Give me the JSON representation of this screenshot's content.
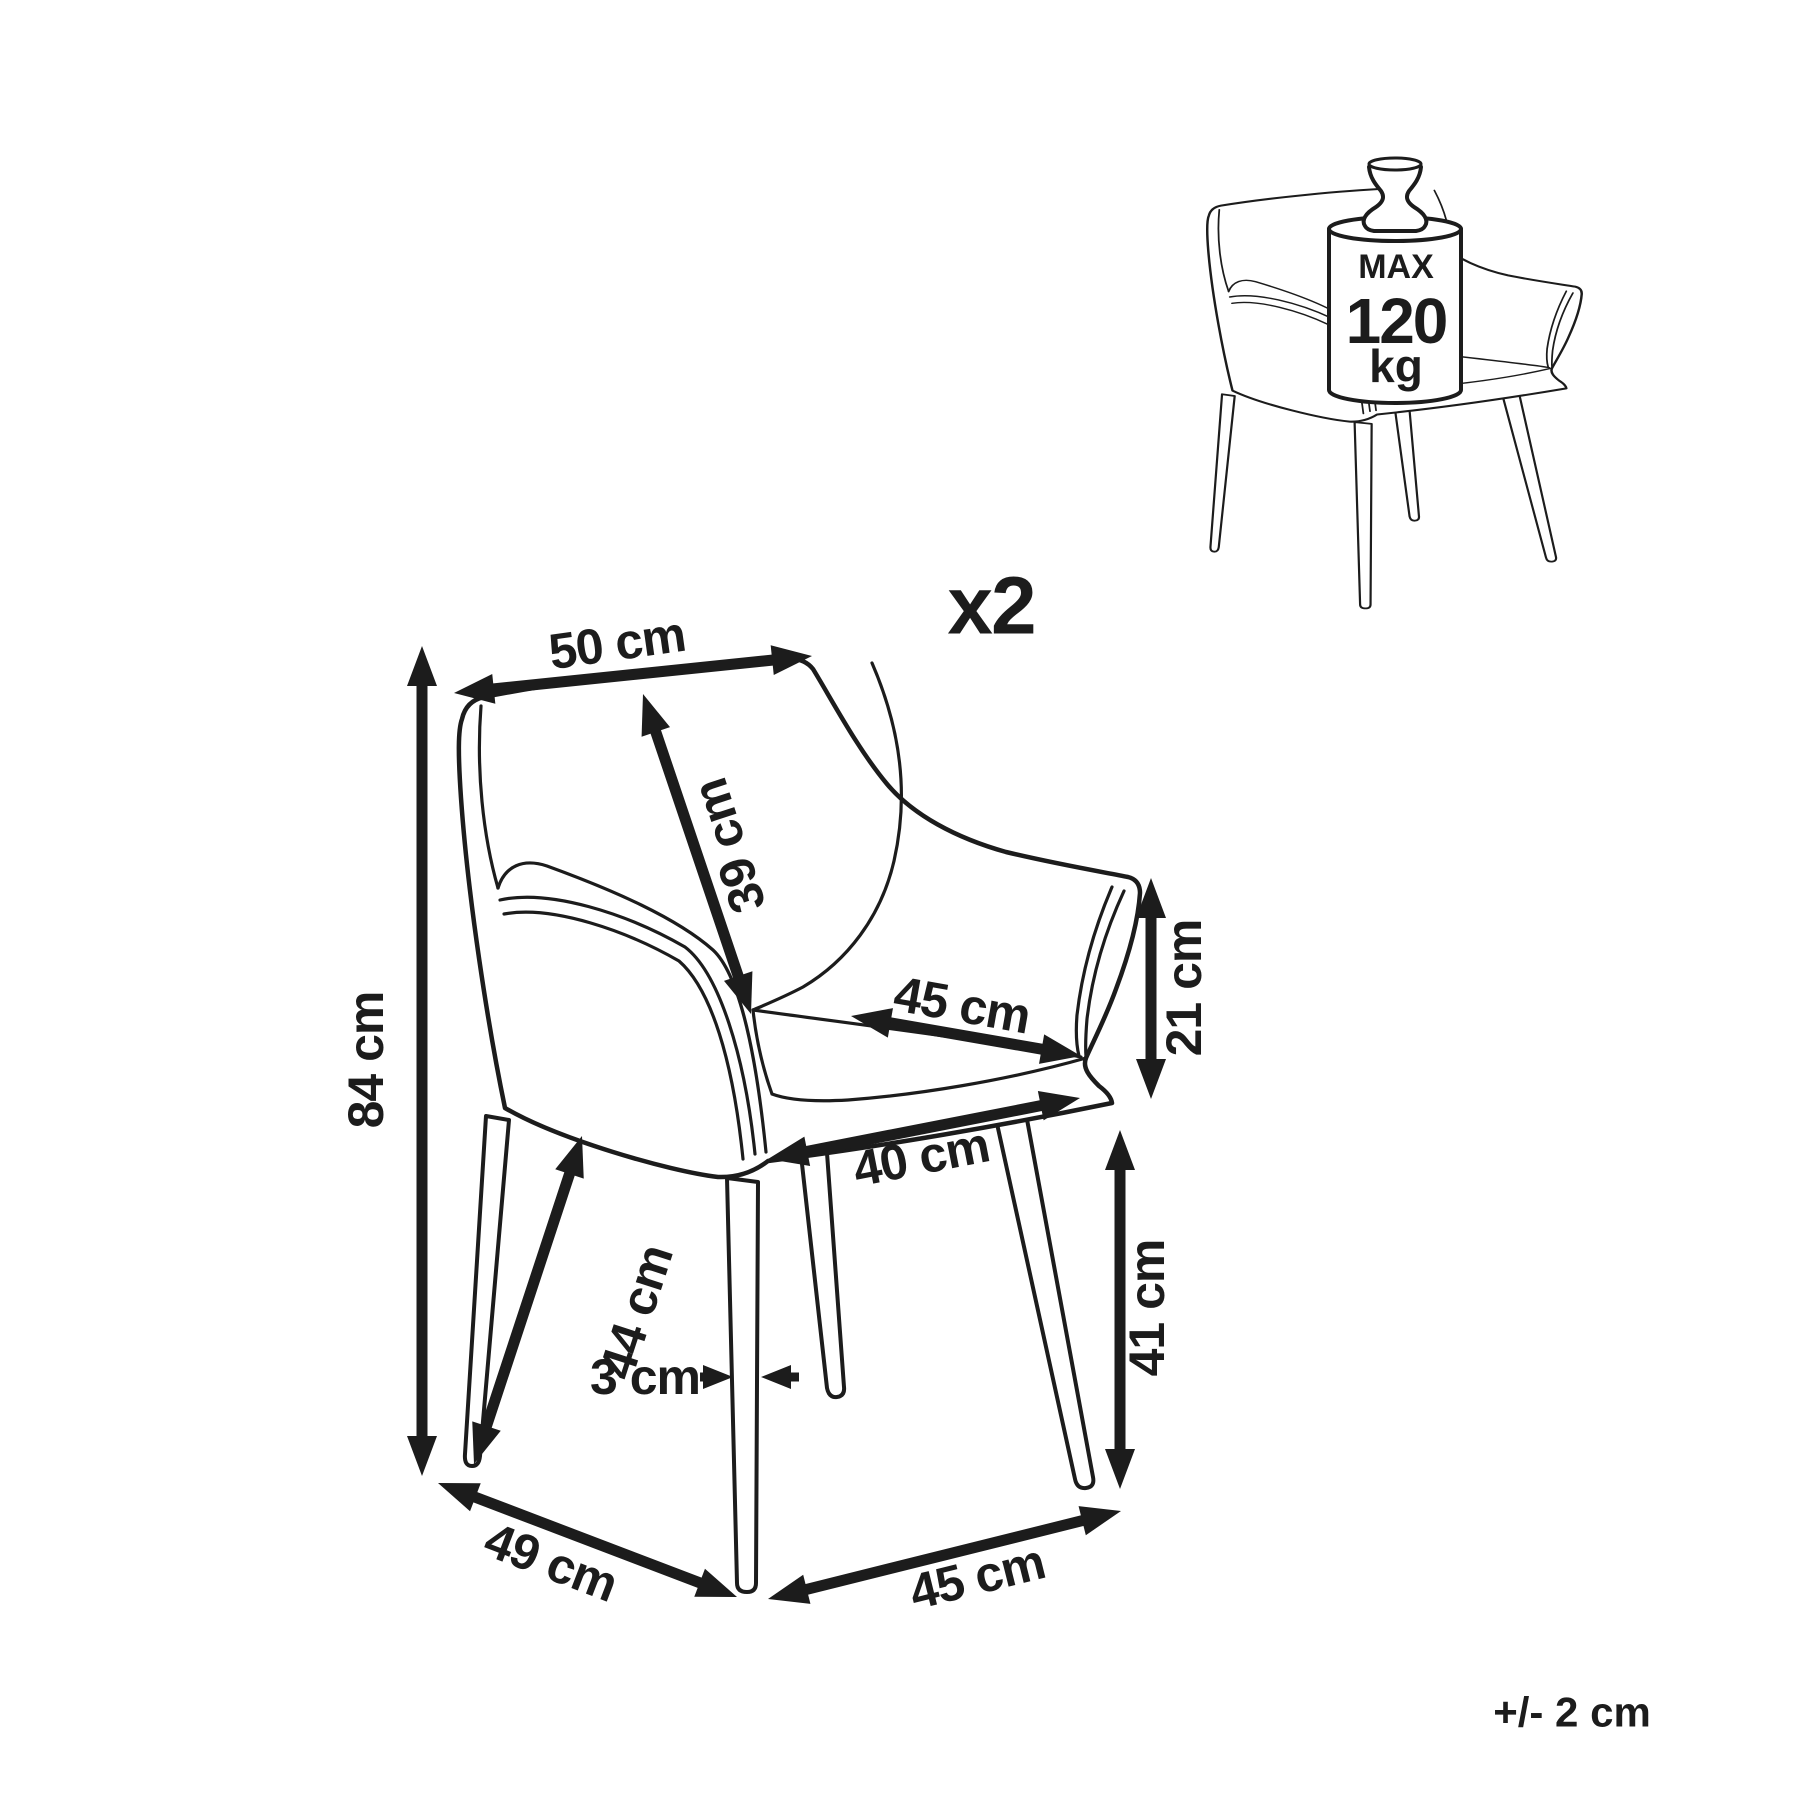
{
  "canvas": {
    "background": "#ffffff",
    "ink": "#1c1c1c",
    "width": 1800,
    "height": 1800
  },
  "labels": {
    "quantity": "x2",
    "tolerance": "+/- 2 cm"
  },
  "weight_badge": {
    "line1": "MAX",
    "line2": "120",
    "line3": "kg"
  },
  "annotations": {
    "arrow_style": {
      "head_length": 40,
      "head_width": 30,
      "shaft_width": 11
    },
    "small_arrow_style": {
      "head_length": 30,
      "head_width": 24,
      "shaft_width": 9
    },
    "label_font_size": 50,
    "dimensions": [
      {
        "id": "seat-back-width",
        "label": "50 cm",
        "x1": 454,
        "y1": 693,
        "x2": 812,
        "y2": 656,
        "label_x": 617,
        "label_y": 643,
        "label_rotate": -8
      },
      {
        "id": "backrest-height",
        "label": "39 cm",
        "x1": 643,
        "y1": 694,
        "x2": 751,
        "y2": 1014,
        "label_x": 729,
        "label_y": 846,
        "label_rotate": -108
      },
      {
        "id": "seat-width",
        "label": "45 cm",
        "x1": 851,
        "y1": 1016,
        "x2": 1081,
        "y2": 1056,
        "label_x": 962,
        "label_y": 1005,
        "label_rotate": 10
      },
      {
        "id": "armrest-height",
        "label": "21 cm",
        "x1": 1151,
        "y1": 878,
        "x2": 1151,
        "y2": 1099,
        "label_x": 1184,
        "label_y": 988,
        "label_rotate": -90
      },
      {
        "id": "total-height",
        "label": "84 cm",
        "x1": 422,
        "y1": 646,
        "x2": 422,
        "y2": 1476,
        "label_x": 366,
        "label_y": 1060,
        "label_rotate": -90
      },
      {
        "id": "seat-depth",
        "label": "40 cm",
        "x1": 768,
        "y1": 1159,
        "x2": 1080,
        "y2": 1098,
        "label_x": 921,
        "label_y": 1157,
        "label_rotate": -11
      },
      {
        "id": "front-leg-length",
        "label": "44 cm",
        "x1": 582,
        "y1": 1136,
        "x2": 474,
        "y2": 1464,
        "label_x": 636,
        "label_y": 1312,
        "label_rotate": -72
      },
      {
        "id": "seat-height",
        "label": "41 cm",
        "x1": 1120,
        "y1": 1130,
        "x2": 1120,
        "y2": 1489,
        "label_x": 1147,
        "label_y": 1308,
        "label_rotate": -90
      },
      {
        "id": "base-depth",
        "label": "49 cm",
        "x1": 438,
        "y1": 1483,
        "x2": 737,
        "y2": 1597,
        "label_x": 551,
        "label_y": 1562,
        "label_rotate": 21
      },
      {
        "id": "base-width",
        "label": "45 cm",
        "x1": 768,
        "y1": 1599,
        "x2": 1121,
        "y2": 1511,
        "label_x": 977,
        "label_y": 1577,
        "label_rotate": -14
      }
    ],
    "leg_thickness": {
      "id": "leg-thickness",
      "label": "3 cm",
      "label_x": 645,
      "label_y": 1377,
      "label_rotate": 0,
      "arrows": [
        {
          "x1": 700,
          "y1": 1377,
          "x2": 733,
          "y2": 1377
        },
        {
          "x1": 799,
          "y1": 1377,
          "x2": 761,
          "y2": 1377
        }
      ]
    }
  }
}
